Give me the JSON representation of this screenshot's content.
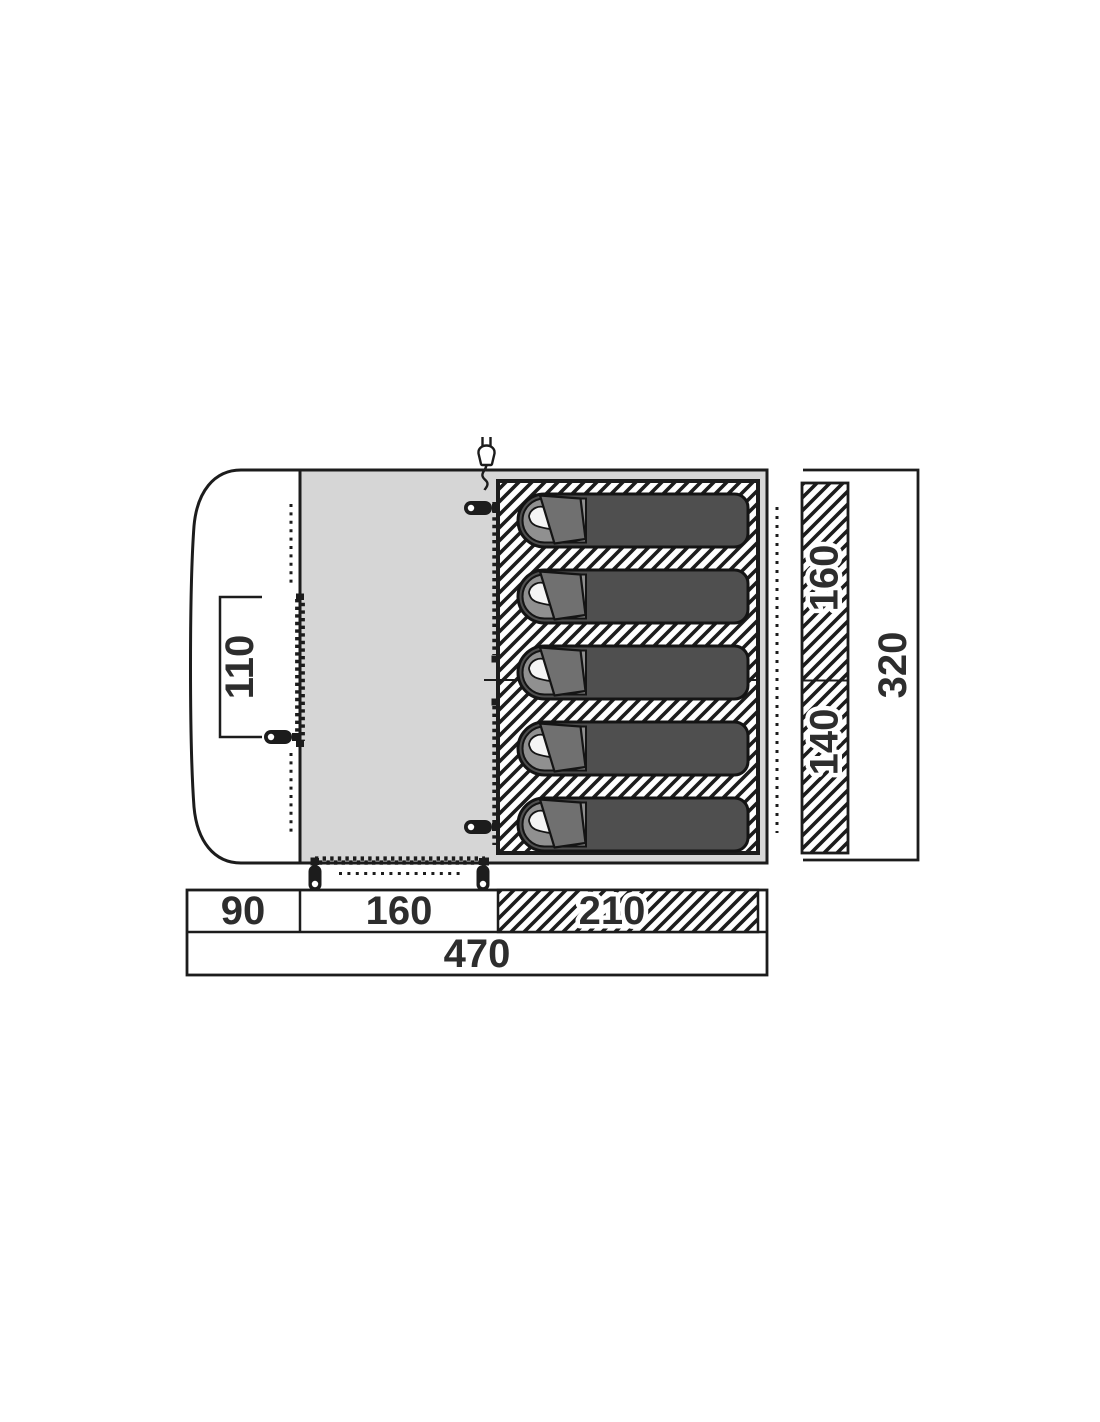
{
  "page": {
    "background": "#ffffff"
  },
  "plan": {
    "type": "tent-floorplan-top-view",
    "sleeping_bag_count": 5,
    "areas": {
      "porch": "curved front porch",
      "living": "living area",
      "bedroom": "sleeping cabin with hatched groundsheet"
    },
    "labels": {
      "porch_width": "110",
      "bedroom_top": "160",
      "bedroom_bottom": "140",
      "total_depth": "320",
      "porch_depth": "90",
      "living_width": "160",
      "bedroom_depth": "210",
      "total_width": "470"
    },
    "icons": {
      "power_inlet": "power-plug-icon"
    },
    "colors": {
      "floor_gray": "#d6d6d6",
      "bag_body": "#4f4f4f",
      "bag_liner": "#909090",
      "bag_flap": "#707070",
      "pillow": "#f4f4f4",
      "line": "#1c1c1c",
      "text": "#2d2d2d"
    }
  }
}
